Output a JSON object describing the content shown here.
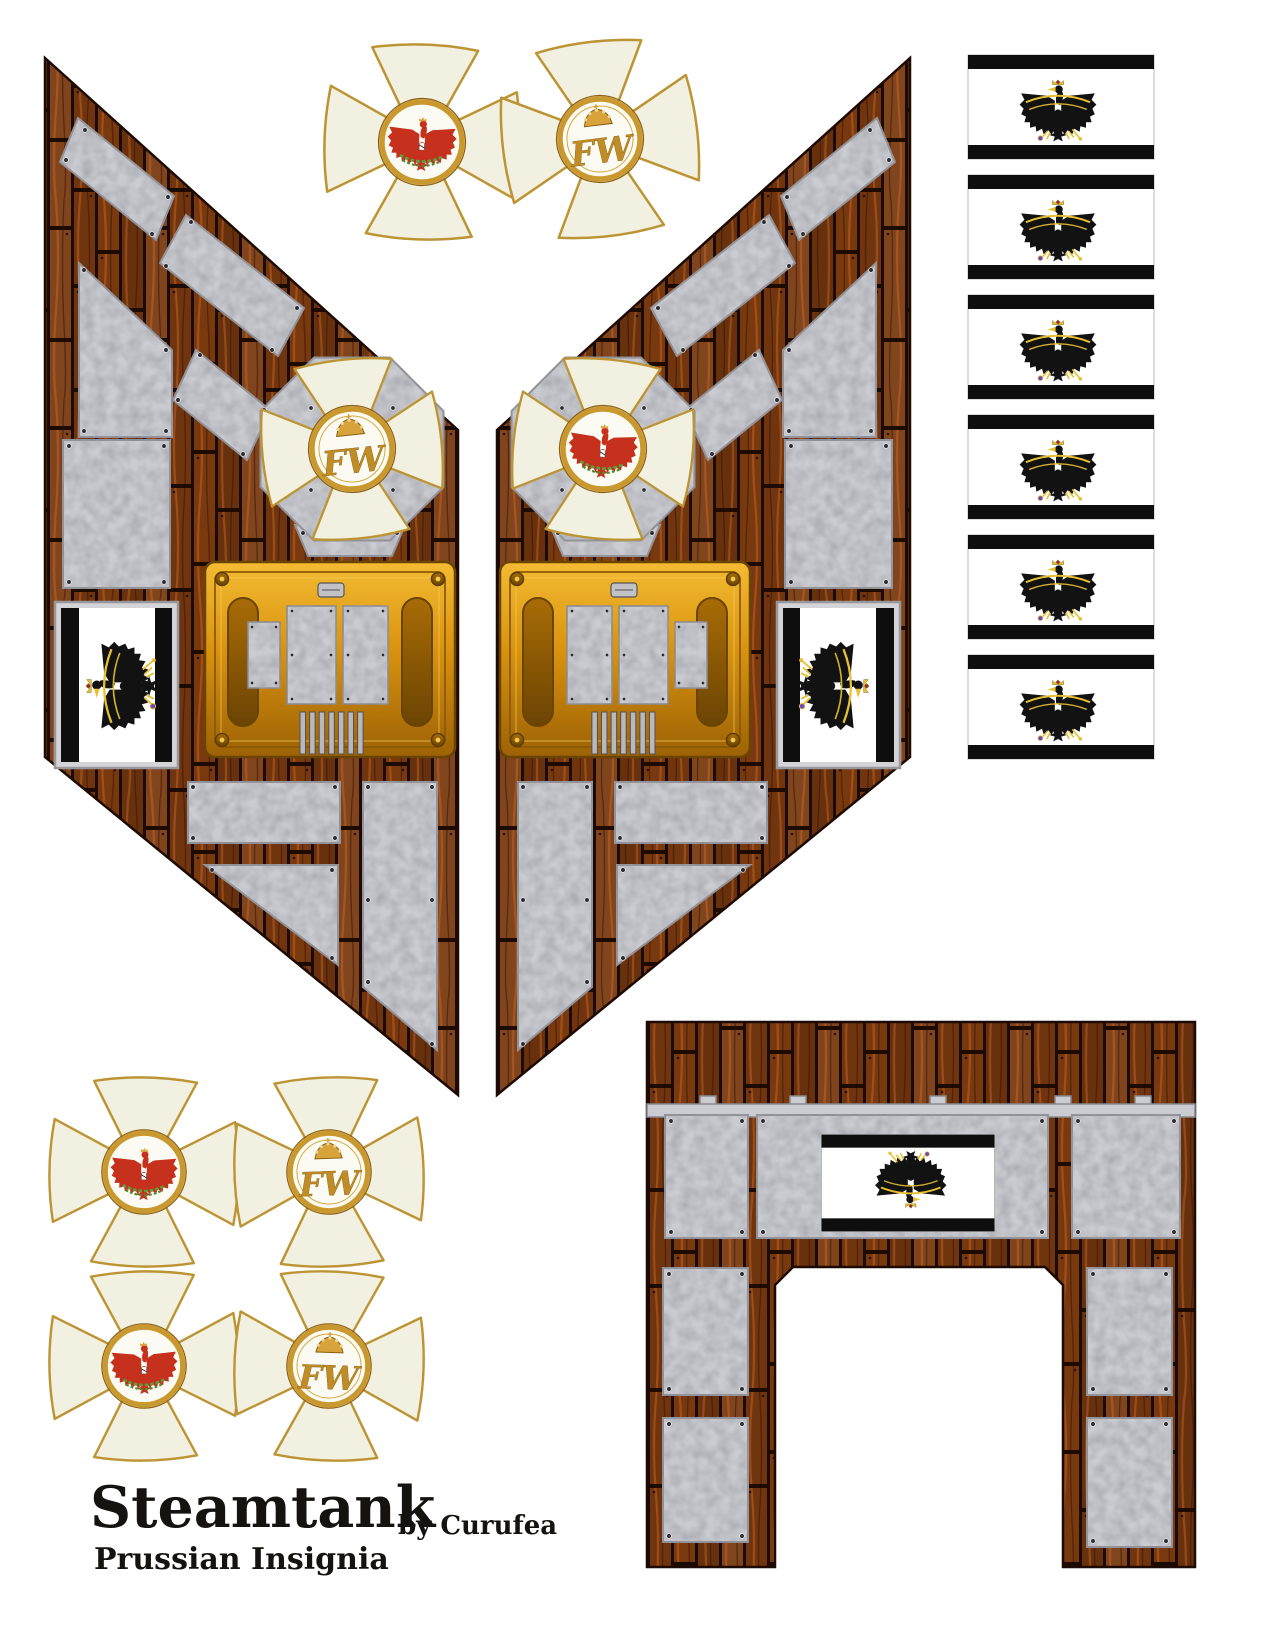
{
  "title": {
    "main": "Steamtank",
    "byline": "by Curufea",
    "subtitle": "Prussian Insignia"
  },
  "insignia": {
    "cipher_letters": "FW",
    "left_panel_medallion": "royal-cipher",
    "right_panel_medallion": "red-eagle",
    "top_crosses": [
      {
        "medallion": "red-eagle"
      },
      {
        "medallion": "royal-cipher"
      }
    ],
    "bottom_crosses": [
      {
        "medallion": "red-eagle"
      },
      {
        "medallion": "royal-cipher"
      },
      {
        "medallion": "red-eagle"
      },
      {
        "medallion": "royal-cipher"
      }
    ]
  },
  "flag_strip": {
    "count": 6,
    "icon": "prussian-eagle-icon"
  },
  "colors": {
    "wood": "#79390f",
    "wood_dark": "#1c0a03",
    "metal": "#caccd1",
    "metal_edge": "#8e8e94",
    "gold": "#d9930f",
    "gold_deep": "#8a5703",
    "gold_trim": "#bd9433",
    "cross_enamel": "#f2f0e0",
    "eagle_black": "#121212",
    "eagle_red": "#c5311c",
    "wreath_green": "#5f9e3c",
    "flag_white": "#ffffff",
    "flag_black": "#0e0e0e",
    "crown_gold": "#d7a33a",
    "accent_yellow": "#e8c030",
    "orb_purple": "#6b46c8",
    "text_black": "#151310"
  }
}
